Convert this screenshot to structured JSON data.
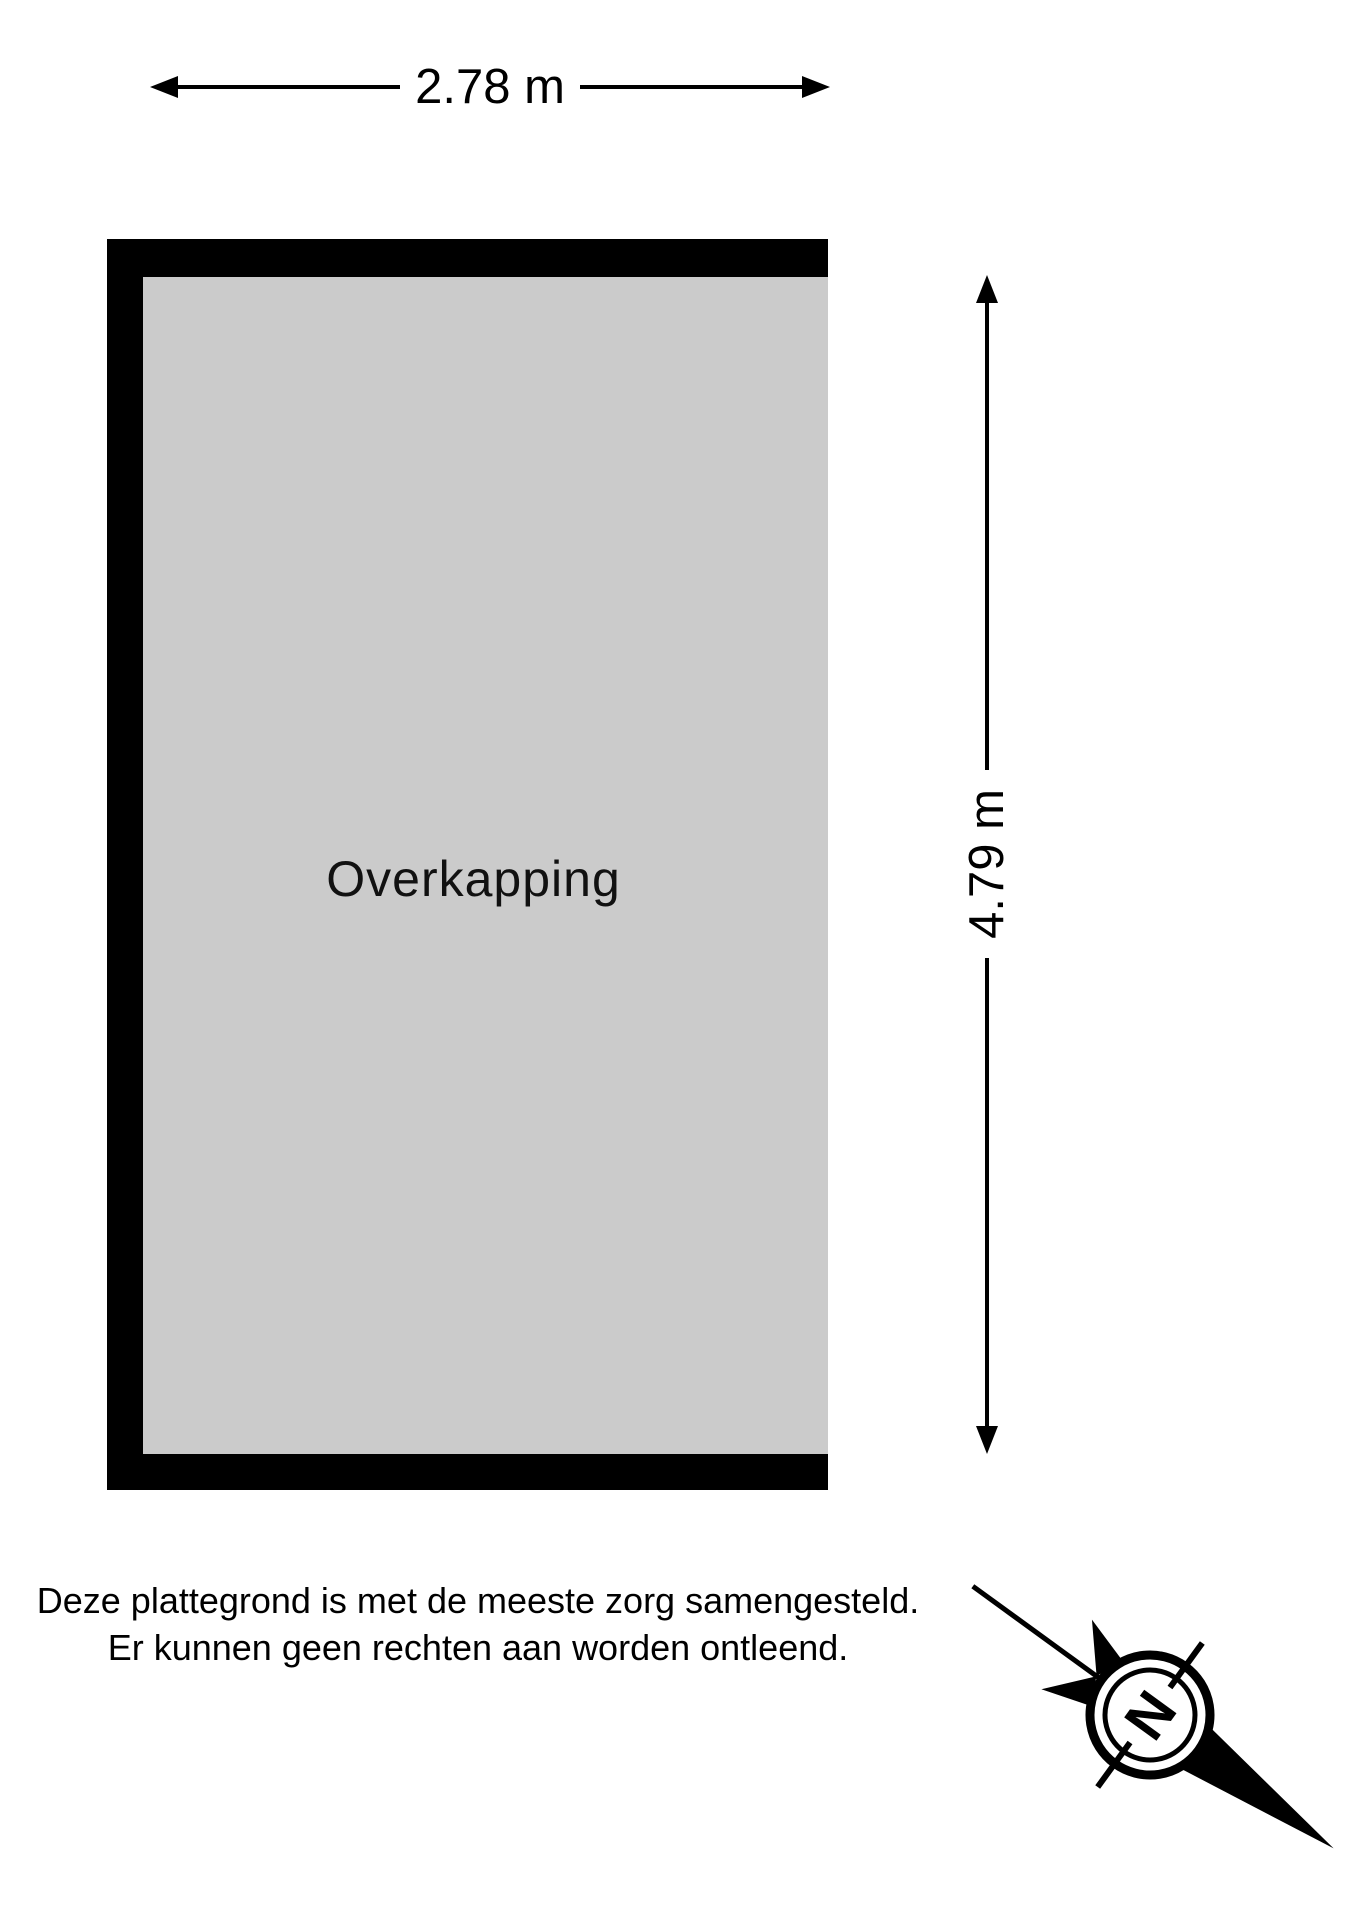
{
  "plan": {
    "room": {
      "label": "Overkapping"
    },
    "dimensions": {
      "width": "2.78 m",
      "depth": "4.79 m"
    }
  },
  "disclaimer": {
    "line1": "Deze plattegrond is met de meeste zorg samengesteld.",
    "line2": "Er kunnen geen rechten aan worden ontleend."
  },
  "compass": {
    "label": "N"
  },
  "colors": {
    "wall": "#000000",
    "floor_fill": "#cbcbcb",
    "background": "#ffffff",
    "dimension_lines": "#000000",
    "text": "#000000"
  }
}
